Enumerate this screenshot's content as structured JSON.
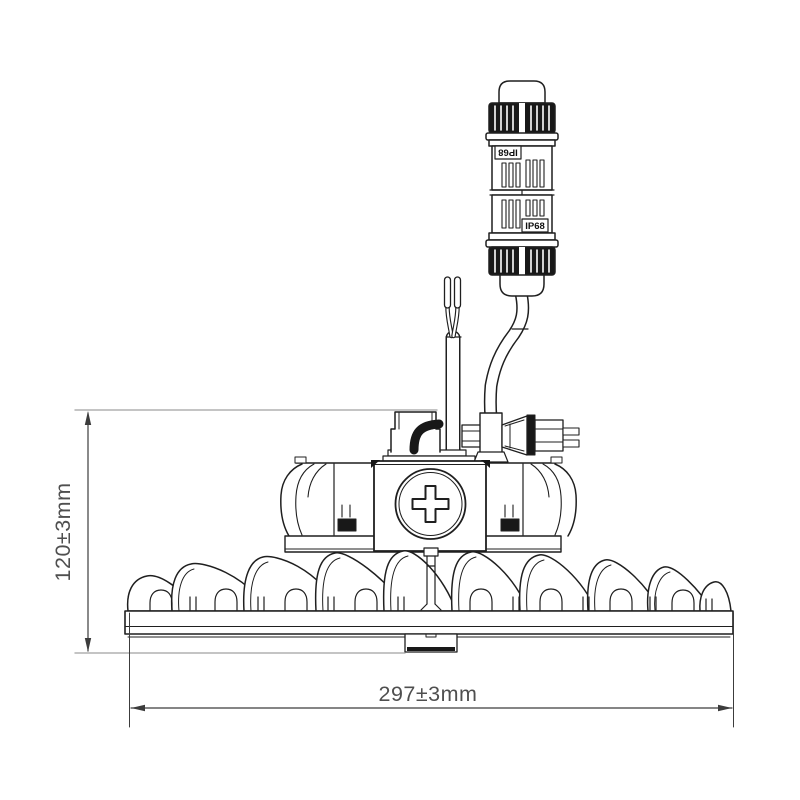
{
  "diagram": {
    "type": "technical-dimension-drawing",
    "subject": "UFO LED high-bay luminaire side elevation with inline IP68 waterproof connector",
    "colors": {
      "background": "#ffffff",
      "line": "#1f1f1f",
      "dark_fill": "#181818",
      "dimension_line": "#3c3c3c",
      "extension_line": "#a0a0a0",
      "text": "#4f4f4f"
    },
    "connector": {
      "label_top": "IP68",
      "label_top_orientation": "rotated-180",
      "label_bottom": "IP68"
    },
    "dimensions": {
      "height": {
        "label": "120±3mm",
        "value": 120,
        "tolerance": 3,
        "unit": "mm",
        "orientation": "vertical"
      },
      "width": {
        "label": "297±3mm",
        "value": 297,
        "tolerance": 3,
        "unit": "mm",
        "orientation": "horizontal"
      }
    }
  }
}
